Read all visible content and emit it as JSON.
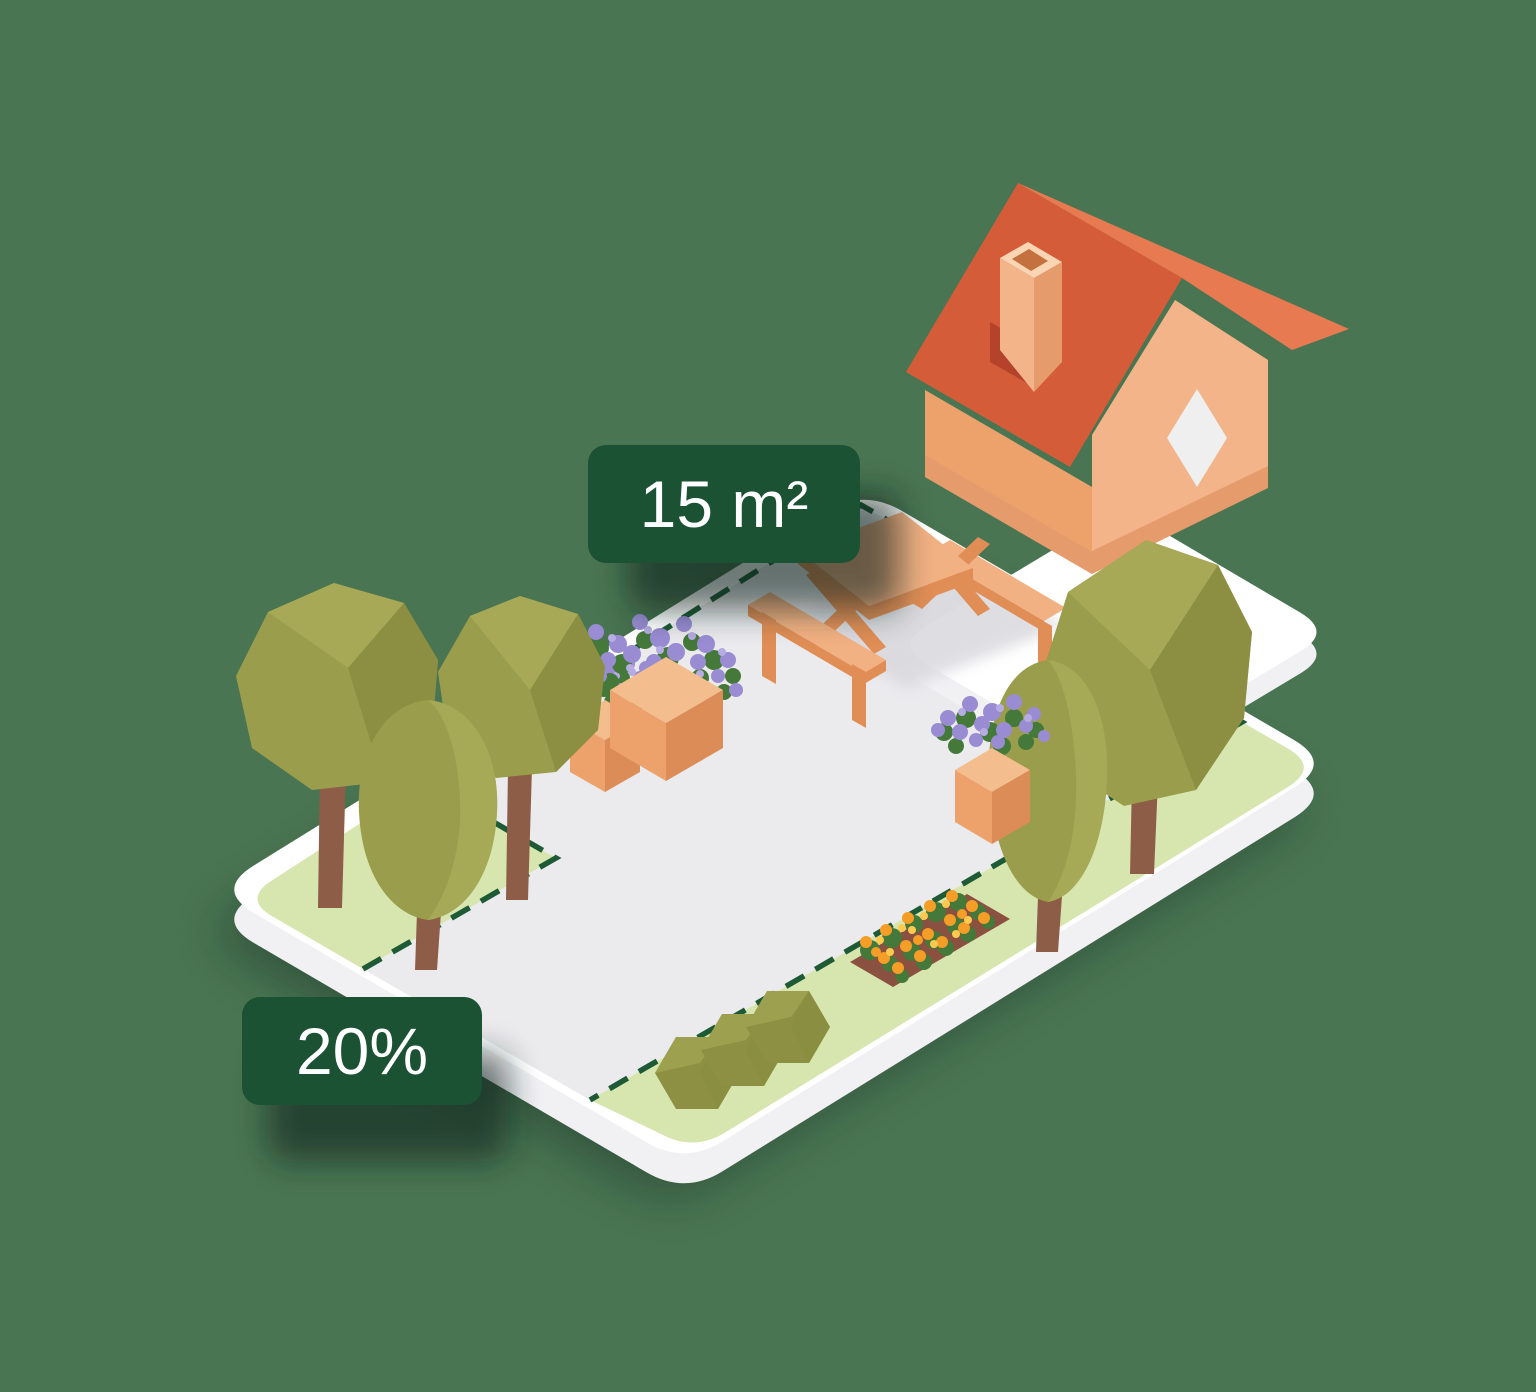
{
  "labels": {
    "area": {
      "text": "15 m²"
    },
    "coverage": {
      "text": "20%"
    }
  },
  "palette": {
    "bg_green": "#4A7552",
    "label_green": "#1B5233",
    "label_text": "#FFFFFF",
    "platform_white": "#FFFFFF",
    "platform_side": "#F1F1F4",
    "pavement_gray": "#EBEBEE",
    "grass_green": "#D7E5AE",
    "dash_green": "#1D5A35",
    "roof_dark": "#D55C38",
    "roof_light": "#E87A52",
    "wall_shaded": "#EDA26B",
    "wall_light": "#F2B488",
    "wall_base": "#E59B6C",
    "window_white": "#EFEFEF",
    "wood_light": "#F2B183",
    "wood_dark": "#E08E56",
    "trunk_brown": "#8E5D47",
    "canopy_olive": "#9A9D4B",
    "canopy_light": "#A9AC59",
    "canopy_dark": "#8A8D40",
    "bush_olive": "#8D9043",
    "planter_light": "#F4BD8D",
    "planter_mid": "#EDA26C",
    "planter_dark": "#DC8C56",
    "flower_purple": "#998CD3",
    "flower_purple_light": "#B6ACE3",
    "foliage_green": "#44793A",
    "soil_brown": "#8A5140",
    "flower_orange": "#F49D27",
    "flower_yellow": "#FFC94F",
    "chimney_shadow": "#B5432B",
    "table_shadow": "#D6D6DC",
    "shadow_dark": "#10241A"
  }
}
